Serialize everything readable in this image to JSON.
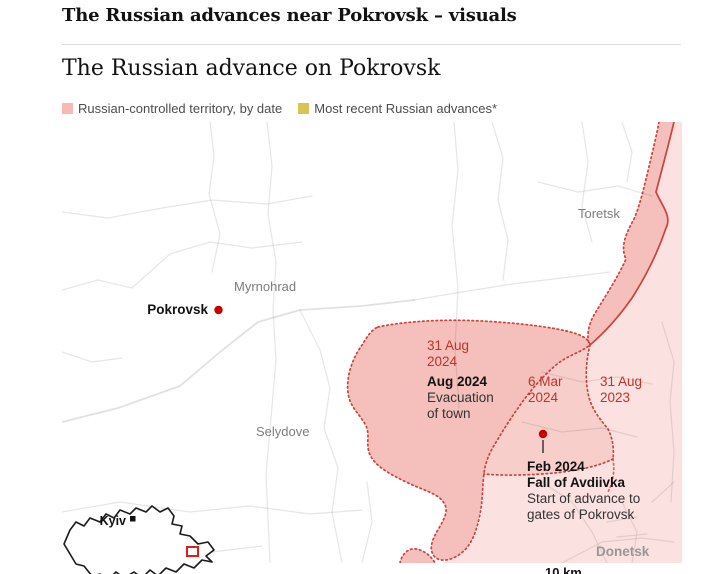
{
  "page": {
    "headline": "The Russian advances near Pokrovsk – visuals",
    "subhead": "The Russian advance on Pokrovsk"
  },
  "legend": {
    "territory_label": "Russian-controlled territory, by date",
    "territory_color": "#f6b9b6",
    "advances_label": "Most recent Russian advances*",
    "advances_color": "#d8c355"
  },
  "map": {
    "cities": {
      "toretsk": "Toretsk",
      "myrnohrad": "Myrnohrad",
      "pokrovsk": "Pokrovsk",
      "selydove": "Selydove",
      "donetsk": "Donetsk"
    },
    "callouts": {
      "adv_31aug2024": {
        "lines": [
          "31 Aug",
          "2024"
        ]
      },
      "evacuation": {
        "title": "Aug 2024",
        "lines": [
          "Evacuation",
          "of town"
        ]
      },
      "adv_6mar2024": {
        "lines": [
          "6 Mar",
          "2024"
        ]
      },
      "adv_31aug2023": {
        "lines": [
          "31 Aug",
          "2023"
        ]
      },
      "avdiivka": {
        "title": "Feb 2024",
        "subtitle": "Fall of Avdiivka",
        "lines": [
          "Start of advance to",
          "gates of Pokrovsk"
        ]
      }
    },
    "colors": {
      "territory_dark": "#f5bfbb",
      "territory_mid": "#f8cecb",
      "territory_light": "#fbe2e0",
      "frontline_red": "#cc423c",
      "date_text_red": "#bf332b",
      "marker_red": "#c70000"
    },
    "scale_label": "10 km"
  },
  "inset": {
    "kyiv_label": "Kyiv"
  }
}
